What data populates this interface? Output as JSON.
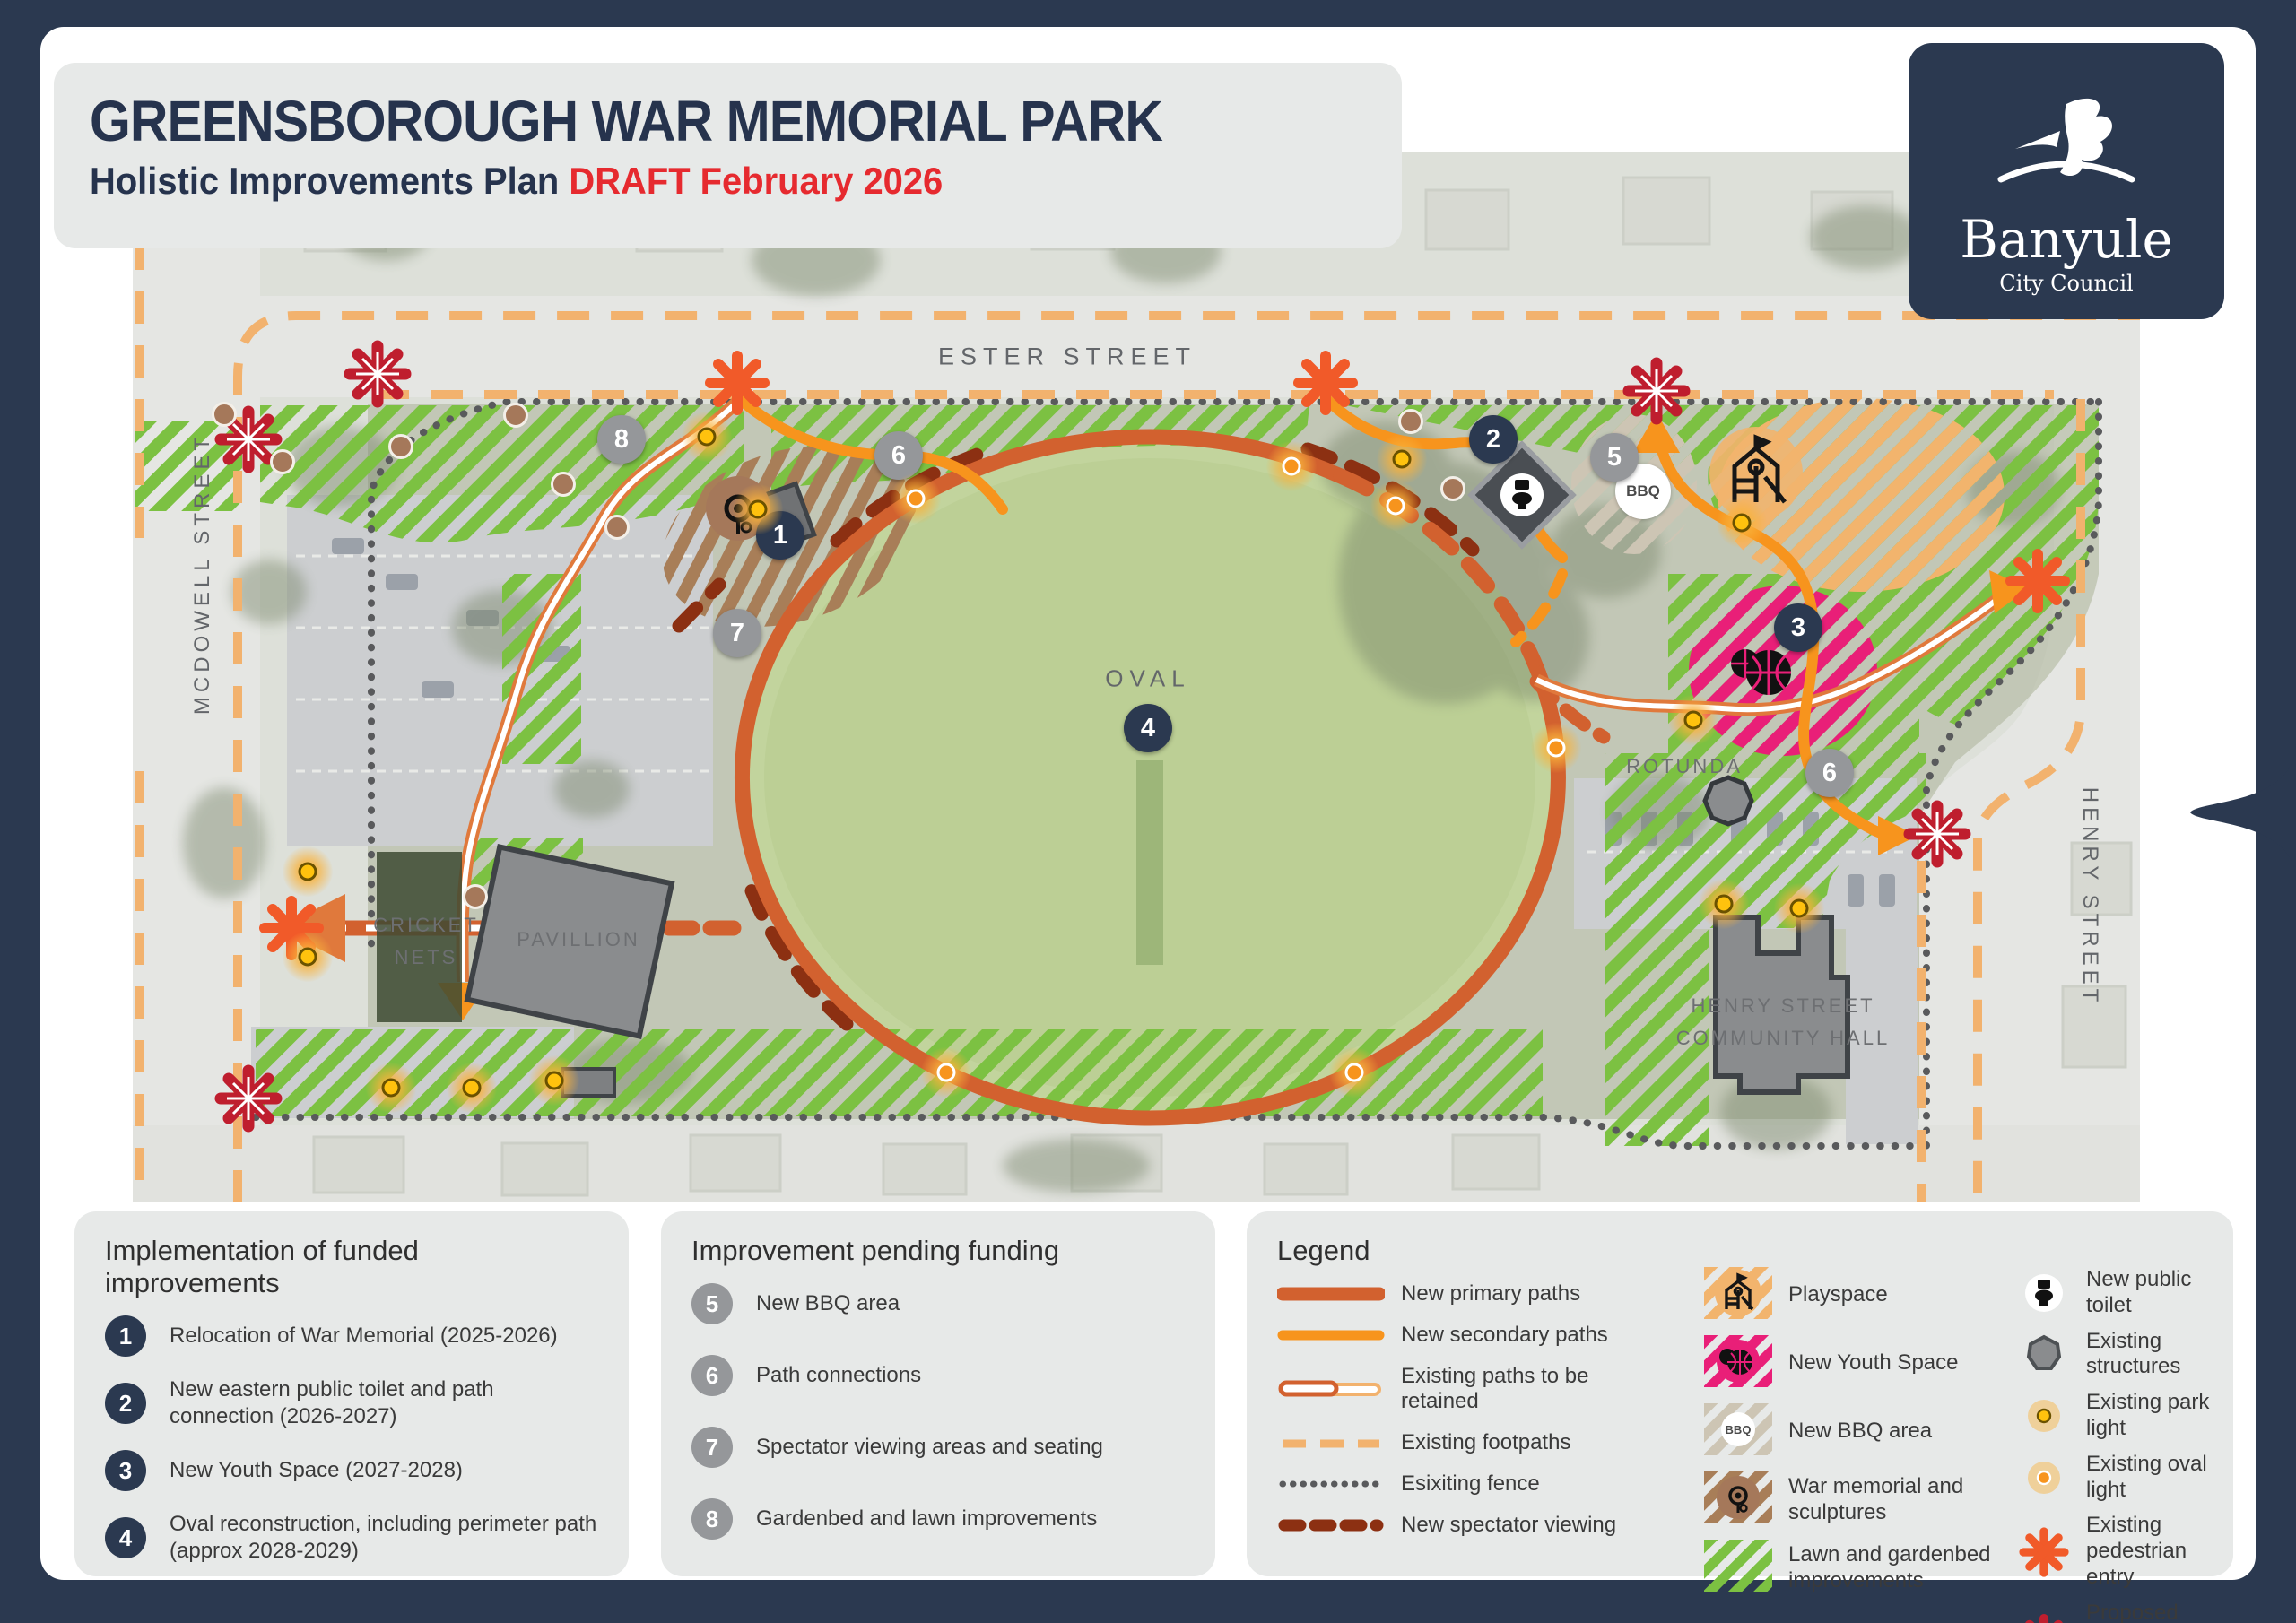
{
  "title_block": {
    "title": "GREENSBOROUGH WAR MEMORIAL PARK",
    "subtitle_plain": "Holistic Improvements Plan ",
    "subtitle_draft": "DRAFT February 2026"
  },
  "logo": {
    "name": "Banyule",
    "subtitle": "City Council"
  },
  "map": {
    "streets": {
      "ester": "ESTER STREET",
      "mcdowell": "MCDOWELL STREET",
      "henry": "HENRY STREET"
    },
    "places": {
      "oval": "OVAL",
      "rotunda": "ROTUNDA",
      "pavillion": "PAVILLION",
      "cricket_line1": "CRICKET",
      "cricket_line2": "NETS",
      "hall_line1": "HENRY STREET",
      "hall_line2": "COMMUNITY HALL",
      "bbq": "BBQ"
    },
    "marker_nums": {
      "n1": "1",
      "n2": "2",
      "n3": "3",
      "n4": "4",
      "n5": "5",
      "n6": "6",
      "n7": "7",
      "n8": "8"
    }
  },
  "funded_panel": {
    "title": "Implementation of funded improvements",
    "items": [
      {
        "num": "1",
        "text": "Relocation of War Memorial (2025-2026)"
      },
      {
        "num": "2",
        "text": "New eastern public toilet and path connection (2026-2027)"
      },
      {
        "num": "3",
        "text": "New Youth Space (2027-2028)"
      },
      {
        "num": "4",
        "text": "Oval reconstruction, including perimeter path (approx 2028-2029)"
      }
    ]
  },
  "pending_panel": {
    "title": "Improvement pending funding",
    "items": [
      {
        "num": "5",
        "text": "New BBQ area"
      },
      {
        "num": "6",
        "text": "Path connections"
      },
      {
        "num": "7",
        "text": "Spectator viewing areas and seating"
      },
      {
        "num": "8",
        "text": "Gardenbed and lawn improvements"
      }
    ]
  },
  "legend": {
    "title": "Legend",
    "lines": [
      {
        "label": "New primary paths"
      },
      {
        "label": "New secondary paths"
      },
      {
        "label": "Existing paths to be retained"
      },
      {
        "label": "Existing footpaths"
      },
      {
        "label": "Esixiting fence"
      },
      {
        "label": "New spectator viewing"
      }
    ],
    "areas": [
      {
        "label": "Playspace"
      },
      {
        "label": "New Youth Space"
      },
      {
        "label": "New BBQ area"
      },
      {
        "label": "War memorial and sculptures"
      },
      {
        "label": "Lawn and gardenbed improvements"
      }
    ],
    "points": [
      {
        "label": "New public toilet"
      },
      {
        "label": "Existing structures"
      },
      {
        "label": "Existing park light"
      },
      {
        "label": "Existing oval light"
      },
      {
        "label": "Existing pedestrian entry"
      },
      {
        "label": "Proposed pedestrian entry"
      }
    ]
  },
  "colors": {
    "navy": "#2b3950",
    "draft_red": "#e62a2f",
    "primary_path": "#d2612f",
    "secondary_path": "#f7941d",
    "footpath": "#f2b26e",
    "fence": "#595a5c",
    "spectator": "#8c3012",
    "lawn_green": "#7cc142",
    "youth_pink": "#e91f78",
    "playspace_orange": "#f2b46d",
    "memorial_brown": "#a87e58",
    "bbq_beige": "#cdc5b4",
    "park_light": "#ffc20e",
    "oval_light": "#f7941d",
    "entry_existing": "#f15a29",
    "entry_proposed": "#bf1e2e",
    "marker_gray": "#95979a"
  }
}
